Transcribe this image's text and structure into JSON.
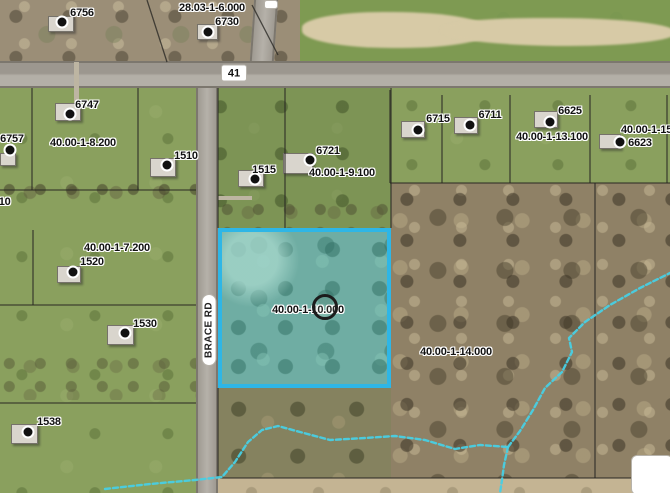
{
  "map": {
    "highlighted_parcel": {
      "label": "40.00-1-10.000",
      "x": 218,
      "y": 228,
      "width": 173,
      "height": 160,
      "border_color": "#2eb6e6",
      "marker": {
        "x": 325,
        "y": 307,
        "diameter": 26
      }
    },
    "road_labels": [
      {
        "text": "41",
        "x": 234,
        "y": 73,
        "style": "shield"
      },
      {
        "text": "BRACE RD",
        "x": 209,
        "y": 330,
        "style": "vertical-pill"
      }
    ],
    "parcel_labels": [
      {
        "text": "6756",
        "x": 82,
        "y": 13
      },
      {
        "text": "28.03-1-6.000",
        "x": 212,
        "y": 8
      },
      {
        "text": "6730",
        "x": 227,
        "y": 22
      },
      {
        "text": "6747",
        "x": 87,
        "y": 105
      },
      {
        "text": "6757",
        "x": 12,
        "y": 139
      },
      {
        "text": "40.00-1-8.200",
        "x": 83,
        "y": 143
      },
      {
        "text": "1510",
        "x": 186,
        "y": 156
      },
      {
        "text": "1515",
        "x": 264,
        "y": 170
      },
      {
        "text": "6721",
        "x": 328,
        "y": 151
      },
      {
        "text": "40.00-1-9.100",
        "x": 342,
        "y": 173
      },
      {
        "text": "6715",
        "x": 438,
        "y": 119
      },
      {
        "text": "6711",
        "x": 490,
        "y": 115
      },
      {
        "text": "6625",
        "x": 570,
        "y": 111
      },
      {
        "text": "40.00-1-13.100",
        "x": 552,
        "y": 137
      },
      {
        "text": "40.00-1-15.",
        "x": 648,
        "y": 130
      },
      {
        "text": "6623",
        "x": 640,
        "y": 143
      },
      {
        "text": "40.00-1-7.200",
        "x": 117,
        "y": 248
      },
      {
        "text": "1520",
        "x": 92,
        "y": 262
      },
      {
        "text": "1530",
        "x": 145,
        "y": 324
      },
      {
        "text": "1538",
        "x": 49,
        "y": 422
      },
      {
        "text": "110",
        "x": 2,
        "y": 202
      },
      {
        "text": "40.00-1-10.000",
        "x": 308,
        "y": 310
      },
      {
        "text": "40.00-1-14.000",
        "x": 456,
        "y": 352
      }
    ],
    "address_points": [
      {
        "x": 62,
        "y": 22
      },
      {
        "x": 208,
        "y": 32
      },
      {
        "x": 70,
        "y": 114
      },
      {
        "x": 10,
        "y": 150
      },
      {
        "x": 167,
        "y": 165
      },
      {
        "x": 255,
        "y": 179
      },
      {
        "x": 310,
        "y": 160
      },
      {
        "x": 418,
        "y": 130
      },
      {
        "x": 470,
        "y": 125
      },
      {
        "x": 550,
        "y": 122
      },
      {
        "x": 620,
        "y": 142
      },
      {
        "x": 73,
        "y": 272
      },
      {
        "x": 125,
        "y": 333
      },
      {
        "x": 28,
        "y": 432
      }
    ],
    "houses": [
      {
        "x": 48,
        "y": 16,
        "w": 26,
        "h": 16
      },
      {
        "x": 197,
        "y": 24,
        "w": 21,
        "h": 16
      },
      {
        "x": 55,
        "y": 103,
        "w": 26,
        "h": 18
      },
      {
        "x": 0,
        "y": 153,
        "w": 16,
        "h": 13
      },
      {
        "x": 150,
        "y": 158,
        "w": 26,
        "h": 19
      },
      {
        "x": 238,
        "y": 170,
        "w": 26,
        "h": 17
      },
      {
        "x": 283,
        "y": 153,
        "w": 30,
        "h": 21
      },
      {
        "x": 401,
        "y": 121,
        "w": 24,
        "h": 17
      },
      {
        "x": 454,
        "y": 117,
        "w": 24,
        "h": 17
      },
      {
        "x": 534,
        "y": 111,
        "w": 24,
        "h": 17
      },
      {
        "x": 599,
        "y": 134,
        "w": 22,
        "h": 15
      },
      {
        "x": 57,
        "y": 266,
        "w": 24,
        "h": 17
      },
      {
        "x": 107,
        "y": 325,
        "w": 27,
        "h": 20
      },
      {
        "x": 11,
        "y": 424,
        "w": 27,
        "h": 20
      }
    ],
    "boundary_lines": [
      [
        32,
        88,
        32,
        190
      ],
      [
        138,
        88,
        138,
        190
      ],
      [
        0,
        190,
        196,
        190
      ],
      [
        33,
        230,
        33,
        305
      ],
      [
        0,
        305,
        196,
        305
      ],
      [
        0,
        403,
        196,
        403
      ],
      [
        218,
        88,
        218,
        228
      ],
      [
        285,
        88,
        285,
        228
      ],
      [
        391,
        88,
        391,
        228
      ],
      [
        218,
        388,
        218,
        478
      ],
      [
        390,
        90,
        390,
        183
      ],
      [
        442,
        95,
        442,
        183
      ],
      [
        510,
        95,
        510,
        183
      ],
      [
        590,
        95,
        590,
        183
      ],
      [
        667,
        95,
        667,
        183
      ],
      [
        390,
        183,
        670,
        183
      ],
      [
        595,
        183,
        595,
        478
      ],
      [
        220,
        478,
        670,
        478
      ],
      [
        147,
        0,
        167,
        62
      ],
      [
        252,
        5,
        278,
        55
      ]
    ],
    "streams": [
      "105,489 150,484 195,480 222,477 235,462 248,442 262,430 278,426 300,432 330,440 365,438 395,436 425,440 455,449 480,445 508,447",
      "508,447 504,465 502,480 500,493",
      "508,447 520,431 533,410 545,388 562,372 572,352 569,338 585,322 610,305 640,288 670,273"
    ],
    "blank_label_box": {
      "x": 631,
      "y": 455,
      "width": 42,
      "height": 40
    },
    "partial_top_label": {
      "x": 264,
      "y": 0,
      "width": 14,
      "height": 9
    },
    "colors": {
      "parcel_highlight_border": "#2eb6e6",
      "parcel_highlight_fill": "rgba(72,190,208,0.22)",
      "stream": "#48cfe4",
      "road": "#a9a49b",
      "label_text": "#111111",
      "label_halo": "#ffffff"
    }
  }
}
